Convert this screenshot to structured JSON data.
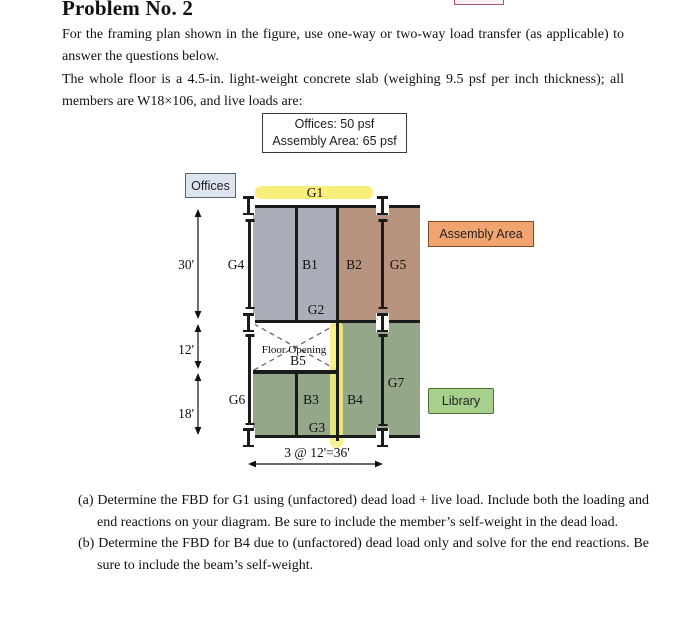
{
  "header": {
    "title": "Problem No. 2"
  },
  "intro": {
    "para1": "For the framing plan shown in the figure, use one-way or two-way load transfer (as applicable) to answer the questions below.",
    "para2": "The whole floor is a 4.5-in. light-weight concrete slab (weighing 9.5 psf per inch thickness); all members are W18×106, and live loads are:"
  },
  "load_box": {
    "offices": "Offices: 50 psf",
    "assembly": "Assembly Area: 65 psf"
  },
  "figure": {
    "area_labels": {
      "offices": "Offices",
      "assembly": "Assembly Area",
      "library": "Library"
    },
    "members": {
      "g1": "G1",
      "g2": "G2",
      "g3": "G3",
      "g4": "G4",
      "g5": "G5",
      "g6": "G6",
      "g7": "G7",
      "b1": "B1",
      "b2": "B2",
      "b3": "B3",
      "b4": "B4",
      "b5": "B5"
    },
    "opening_label": "Floor Opening",
    "dims": {
      "left_top": "30'",
      "left_mid": "12'",
      "left_bottom": "18'",
      "bottom": "3 @ 12'=36'"
    },
    "colors": {
      "slab-gray": "#a9aeb8",
      "slab-brown": "#b8937e",
      "slab-green": "#95a789",
      "hl-yellow": "#f7ee7b",
      "offices-bg": "#dce4f0",
      "assembly-bg": "#f2a470",
      "library-bg": "#a6d08c",
      "line": "#1b1b1b"
    }
  },
  "questions": {
    "a_marker": "(a)",
    "a_text": " Determine the FBD for G1 using (unfactored) dead load + live load. Include both the loading and end reactions on your diagram. Be sure to include the member’s self-weight in the dead load.",
    "b_marker": "(b)",
    "b_text": " Determine the FBD for B4 due to (unfactored) dead load only and solve for the end reactions. Be sure to include the beam’s self-weight."
  }
}
